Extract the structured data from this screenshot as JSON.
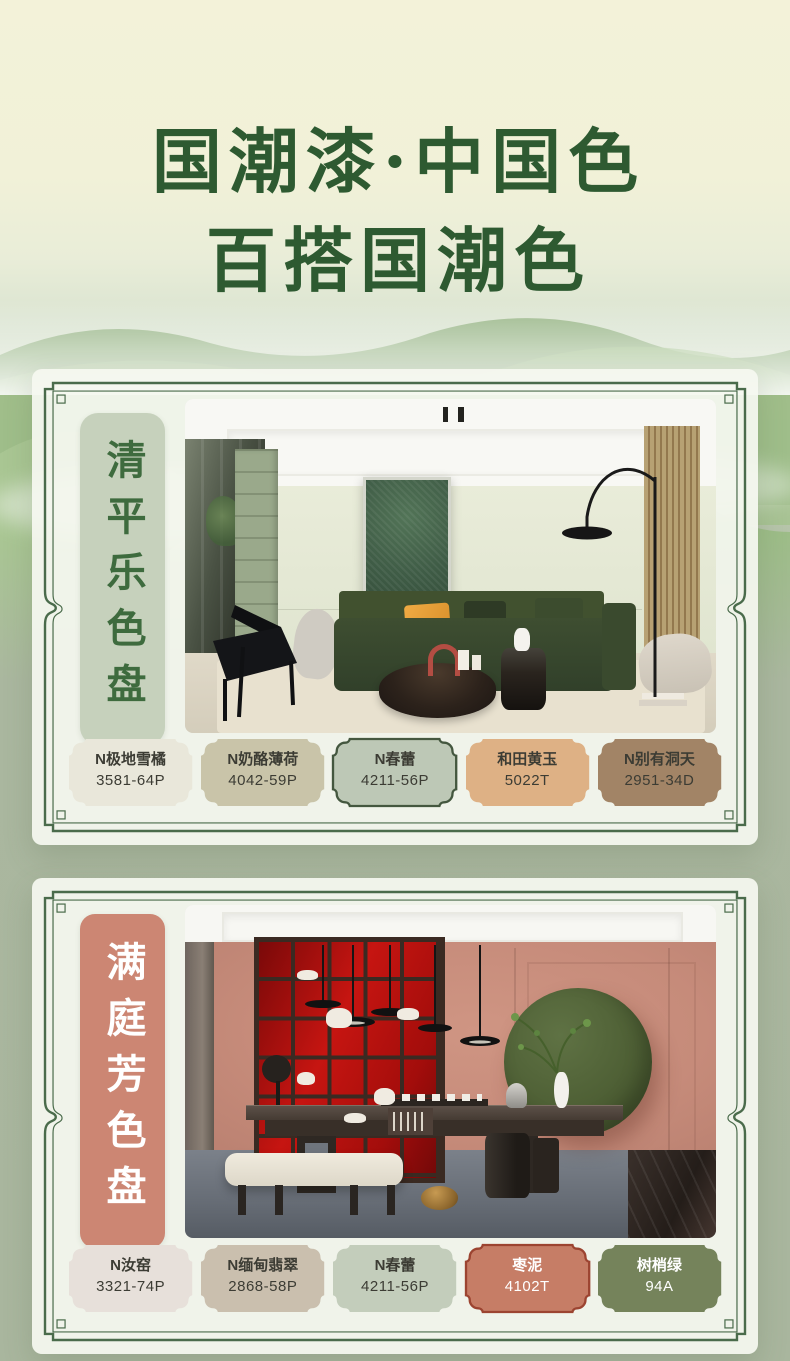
{
  "theme": {
    "title_color": "#2e5a31",
    "border_green": "#4a6b4b",
    "page_top_bg": "#f3f2d9",
    "page_bottom_bg": "#a9b69e"
  },
  "header": {
    "line1": "国潮漆·中国色",
    "line2": "百搭国潮色"
  },
  "palettes": [
    {
      "name": "清平乐色盘",
      "label_bg": "#c6d1bc",
      "label_text_color": "#3e6b3e",
      "swatches": [
        {
          "name": "N极地雪橘",
          "code": "3581-64P",
          "color": "#e9e7da",
          "text_color": "#3c3c34",
          "border": "none"
        },
        {
          "name": "N奶酪薄荷",
          "code": "4042-59P",
          "color": "#c9c4a9",
          "text_color": "#3c3c34",
          "border": "none"
        },
        {
          "name": "N春蕾",
          "code": "4211-56P",
          "color": "#bdc8b6",
          "text_color": "#3c3c34",
          "border": "#44573f"
        },
        {
          "name": "和田黄玉",
          "code": "5022T",
          "color": "#deb185",
          "text_color": "#3c3c34",
          "border": "none"
        },
        {
          "name": "N别有洞天",
          "code": "2951-34D",
          "color": "#a28466",
          "text_color": "#3c3c34",
          "border": "none"
        }
      ]
    },
    {
      "name": "满庭芳色盘",
      "label_bg": "#cc8673",
      "label_text_color": "#ffffff",
      "swatches": [
        {
          "name": "N汝窑",
          "code": "3321-74P",
          "color": "#e7e0da",
          "text_color": "#3c3c34",
          "border": "none"
        },
        {
          "name": "N缅甸翡翠",
          "code": "2868-58P",
          "color": "#cabfae",
          "text_color": "#3c3c34",
          "border": "none"
        },
        {
          "name": "N春蕾",
          "code": "4211-56P",
          "color": "#c3cdbb",
          "text_color": "#3c3c34",
          "border": "none"
        },
        {
          "name": "枣泥",
          "code": "4102T",
          "color": "#c67d66",
          "text_color": "#ffffff",
          "border": "#9c4431"
        },
        {
          "name": "树梢绿",
          "code": "94A",
          "color": "#75835b",
          "text_color": "#ffffff",
          "border": "none"
        }
      ]
    }
  ]
}
